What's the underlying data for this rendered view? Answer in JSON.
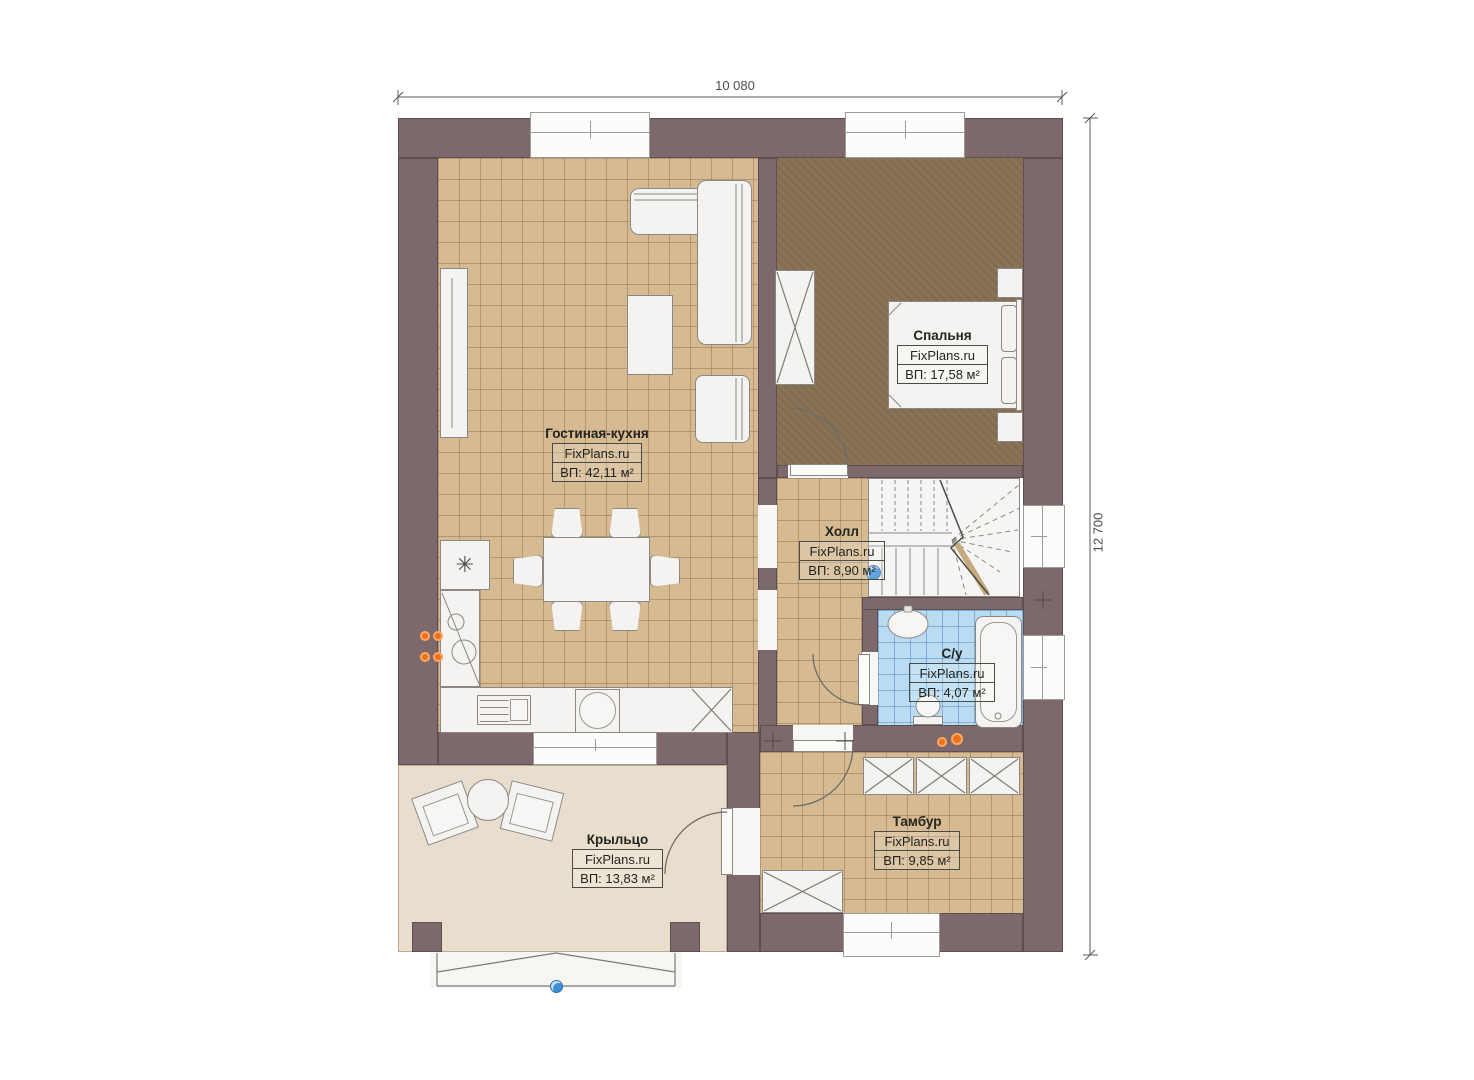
{
  "site_brand": "FixPlans.ru",
  "dimensions": {
    "width_label": "10 080",
    "height_label": "12 700"
  },
  "rooms": [
    {
      "id": "living",
      "name": "Гостиная-кухня",
      "brand": "FixPlans.ru",
      "area": "ВП: 42,11 м²"
    },
    {
      "id": "bedroom",
      "name": "Спальня",
      "brand": "FixPlans.ru",
      "area": "ВП: 17,58 м²"
    },
    {
      "id": "hall",
      "name": "Холл",
      "brand": "FixPlans.ru",
      "area": "ВП: 8,90 м²"
    },
    {
      "id": "bathroom",
      "name": "С/у",
      "brand": "FixPlans.ru",
      "area": "ВП: 4,07 м²"
    },
    {
      "id": "tambour",
      "name": "Тамбур",
      "brand": "FixPlans.ru",
      "area": "ВП: 9,85 м²"
    },
    {
      "id": "porch",
      "name": "Крыльцо",
      "brand": "FixPlans.ru",
      "area": "ВП: 13,83 м²"
    }
  ],
  "icons": {
    "freezer": "✳"
  },
  "colors": {
    "wall": "#7d686c",
    "floor_tile_tan": "#d5ba92",
    "floor_bedroom": "#8a7455",
    "floor_bathroom": "#b9dcf2",
    "floor_porch": "#e9decd",
    "accent_marker_blue": "#3f8fd6",
    "stove_orange": "#ed7116"
  }
}
